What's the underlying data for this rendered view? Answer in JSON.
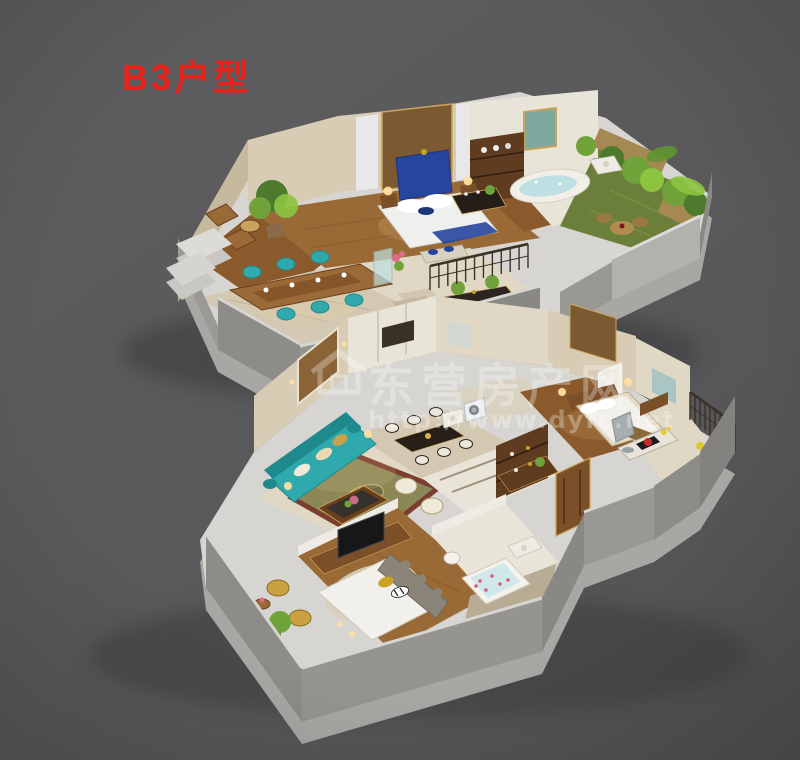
{
  "title": {
    "text": "B3户型"
  },
  "watermark": {
    "site_name": "东营房产网",
    "url": "http://www.dyfc.net",
    "icon": "house-icon"
  },
  "palette": {
    "background": "#59585a",
    "title_red": "#e9221b",
    "watermark_white": "#ffffff",
    "slab_top": "#d7d5d1",
    "slab_side": "#a9a7a3",
    "front_wall_gray": "#8e8c89",
    "front_wall_gray2": "#96948f",
    "parapet_gray": "#b3b1ac",
    "wall_cream": "#d8cdb4",
    "wall_cream_dark": "#c6b99d",
    "wall_white": "#edebe4",
    "wood_floor": "#8a5a2c",
    "wood_floor_light": "#9a6a36",
    "wood_dark": "#6b3f1c",
    "cabinet_brown": "#5f3b20",
    "cabinet_brown2": "#7b4f28",
    "tile": "#d3c8b2",
    "tile_light": "#e0d8c4",
    "marble": "#e9e4d8",
    "marble_dark": "#d9d2c0",
    "grass": "#6b7f3a",
    "plant_dark": "#4e7a2e",
    "plant_mid": "#6fa33a",
    "plant_light": "#8cc43f",
    "teal": "#2fa9ac",
    "teal_dark": "#1f8a8e",
    "royal_blue": "#27459e",
    "royal_blue_dark": "#1c3579",
    "rug_olive": "#8b8757",
    "rug_border": "#7a3d30",
    "bed_white": "#f2f0ea",
    "bed_cream": "#e6dcc6",
    "headboard_gray": "#8a8578",
    "gold": "#c9a227",
    "glow_warm": "#ffdf9f",
    "feature_brown": "#7b5a33",
    "tuft_brown": "#8a6436",
    "rail_dark": "#3a3127",
    "shadow": "#3a3a3c"
  },
  "scene": {
    "type": "3d-cutaway-floorplan",
    "unit": "B3",
    "floors": [
      {
        "id": "upper-floor",
        "rooms": [
          "sitting-area",
          "master-bedroom",
          "walk-in-closet",
          "master-bathroom",
          "roof-garden-terrace",
          "dining-room",
          "stair-hall"
        ]
      },
      {
        "id": "lower-floor",
        "rooms": [
          "living-room",
          "dining-area",
          "bathroom-laundry",
          "master-bedroom",
          "kitchen",
          "balcony",
          "second-bedroom",
          "en-suite-bathroom",
          "entry-courtyard",
          "staircase"
        ]
      }
    ]
  }
}
